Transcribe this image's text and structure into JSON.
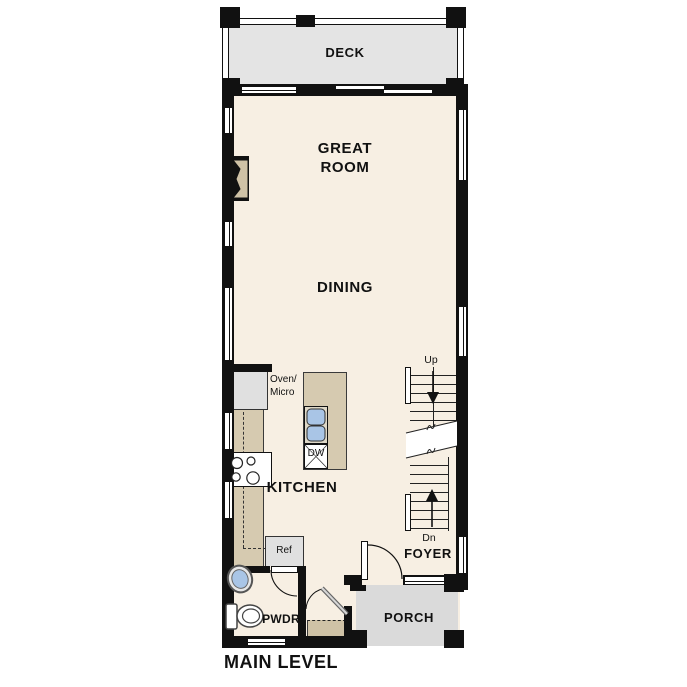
{
  "title": "MAIN LEVEL",
  "rooms": {
    "deck": "DECK",
    "great_room_line1": "GREAT",
    "great_room_line2": "ROOM",
    "dining": "DINING",
    "kitchen": "KITCHEN",
    "foyer": "FOYER",
    "porch": "PORCH",
    "powder": "PWDR"
  },
  "appliances": {
    "oven_line1": "Oven/",
    "oven_line2": "Micro",
    "dishwasher": "DW",
    "refrigerator": "Ref"
  },
  "stairs": {
    "up_label": "Up",
    "down_label": "Dn"
  },
  "colors": {
    "wall": "#111111",
    "floor": "#f7efe3",
    "deck": "#e4e4e4",
    "porch": "#dadada",
    "counter": "#d6cab0",
    "appliance": "#e0e0e0",
    "sink": "#a9c5e6",
    "fireplace": "#cfc2a6"
  }
}
